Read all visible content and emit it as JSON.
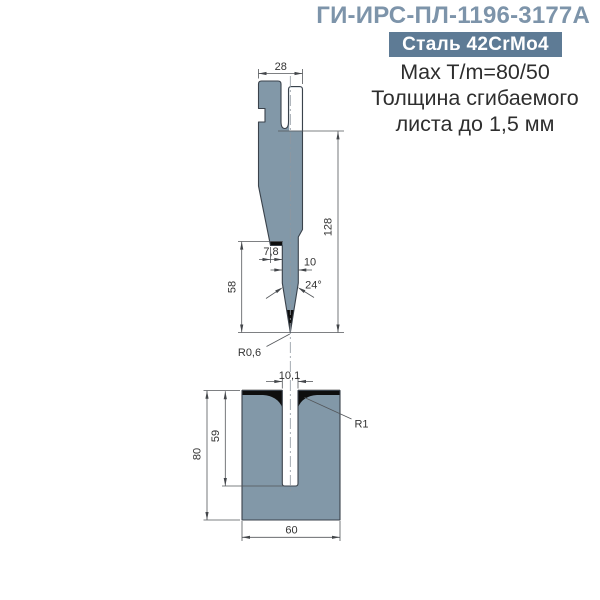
{
  "header": {
    "title": "ГИ-ИРС-ПЛ-1196-3177А",
    "badge": "Сталь 42CrMo4",
    "line1": "Max T/m=80/50",
    "line2": "Толщина сгибаемого",
    "line3": "листа до 1,5 мм"
  },
  "colors": {
    "accent_title": "#7D94AA",
    "badge_bg": "#5E7B95",
    "metal_fill": "#8298A8",
    "hardened_black": "#0E0E0E"
  },
  "drawing": {
    "punch": {
      "dims": {
        "width": "28",
        "length": "128",
        "tip_length": "58",
        "shoulder": "7,8",
        "blade_width": "10",
        "tip_angle": "24°",
        "tip_radius": "R0,6"
      }
    },
    "die": {
      "dims": {
        "slot_width": "10,1",
        "entry_radius": "R1",
        "slot_depth": "59",
        "height": "80",
        "width": "60"
      }
    }
  }
}
